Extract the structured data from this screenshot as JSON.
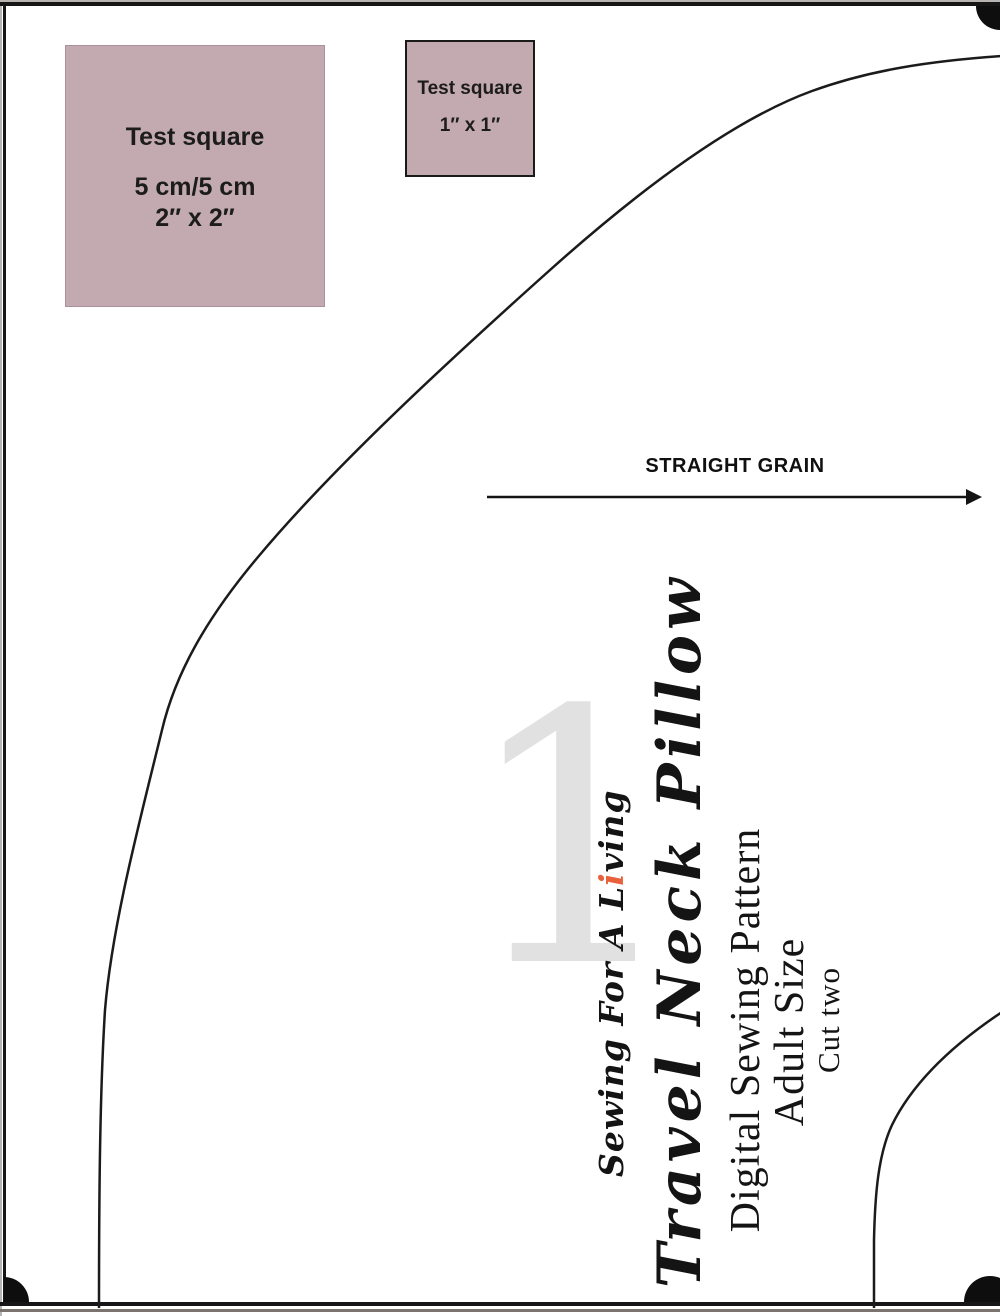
{
  "page": {
    "description": "Digital sewing pattern printable page",
    "page_number": "1",
    "background_color": "#ffffff",
    "border_color": "#161616",
    "test_square_fill": "#c3aab1",
    "watermark_color": "#e1e1e1",
    "accent_color": "#e8613c"
  },
  "test_squares": {
    "large": {
      "title": "Test square",
      "metric": "5 cm/5 cm",
      "imperial": "2″ x 2″"
    },
    "small": {
      "title": "Test square",
      "imperial": "1″ x 1″"
    }
  },
  "grain": {
    "label": "STRAIGHT GRAIN"
  },
  "watermark": {
    "page_number": "1"
  },
  "titles": {
    "brand_prefix": "Sewing For A L",
    "brand_accent": "i",
    "brand_suffix": "ving",
    "pattern_name": "Travel Neck Pillow",
    "subtitle": "Digital Sewing Pattern",
    "size": "Adult Size",
    "cut_instruction": "Cut two"
  }
}
